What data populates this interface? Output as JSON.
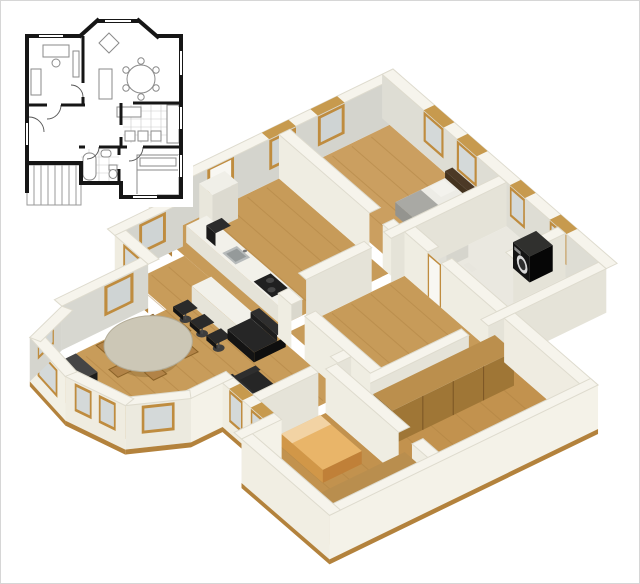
{
  "page": {
    "width": 640,
    "height": 584,
    "background": "#ffffff",
    "border_color": "#d6d6d6",
    "content_type": "architectural floor-plan visualization, no text"
  },
  "inset_plan_2d": {
    "wall_color": "#161616",
    "furniture_outline_color": "#8a8a8a",
    "tile_line_color": "#c9c9c9",
    "stairs_hatch_color": "#9a9a9a",
    "background": "#ffffff",
    "elements": [
      "exterior-walls",
      "bay-window",
      "windows",
      "interior-walls",
      "door-swings",
      "desk",
      "desk-chair",
      "bookshelf",
      "sofa",
      "armchair",
      "round-dining-table",
      "dining-chairs",
      "coffee-table",
      "kitchen-tiles",
      "kitchen-counter",
      "stove",
      "bathroom-tiles",
      "bathtub",
      "wash-basin",
      "toilet",
      "double-bed",
      "staircase"
    ]
  },
  "render_3d": {
    "projection": "axonometric cutaway (walls cut at constant height)",
    "colors": {
      "wall_top": "#f6f4ec",
      "wall_exterior_bright": "#f4f2e8",
      "wall_exterior_side": "#efece0",
      "wall_interior_lit": "#efede2",
      "wall_interior_mid": "#e5e3d8",
      "wall_interior_shadow": "#d4d4cd",
      "wood_floor": "#c79b59",
      "plank_line": "#ad8040",
      "wood_trim": "#bf8c3f",
      "window_glass": "#d4d9d9",
      "slab_edge": "#b3823c",
      "bath_floor": "#eae8e0",
      "dark_furniture": "#1a1a1a",
      "bed_linen_white": "#edece6",
      "bed_blanket_gray": "#a9a9a4",
      "headboard_wood": "#4c3926",
      "bed_orange": "#e9b569",
      "pillow_orange": "#f2d3a4",
      "wardrobe_wood": "#b98e4e",
      "counter_white": "#f2f1ea",
      "table_top": "#ccc7b6"
    },
    "rooms": [
      "bedroom-top",
      "bathroom",
      "hallway",
      "kitchen",
      "living-dining-room",
      "bedroom-bottom",
      "corridor"
    ],
    "furniture": [
      "double-bed-white",
      "headboard-bench",
      "washing-machine",
      "toilet",
      "pedestal-sink",
      "fridge",
      "kitchen-counter",
      "cooktop",
      "kitchen-sink",
      "coffee-machine",
      "breakfast-island",
      "bar-stool-1",
      "bar-stool-2",
      "bar-stool-3",
      "round-dining-table",
      "dining-chairs-x6",
      "sofa-large",
      "loveseat",
      "radiator-bench",
      "window-seat",
      "double-bed-orange",
      "corridor-wardrobe",
      "bedroom-wardrobe"
    ],
    "window_count_exterior": 14,
    "bar_stool_count": 3
  }
}
